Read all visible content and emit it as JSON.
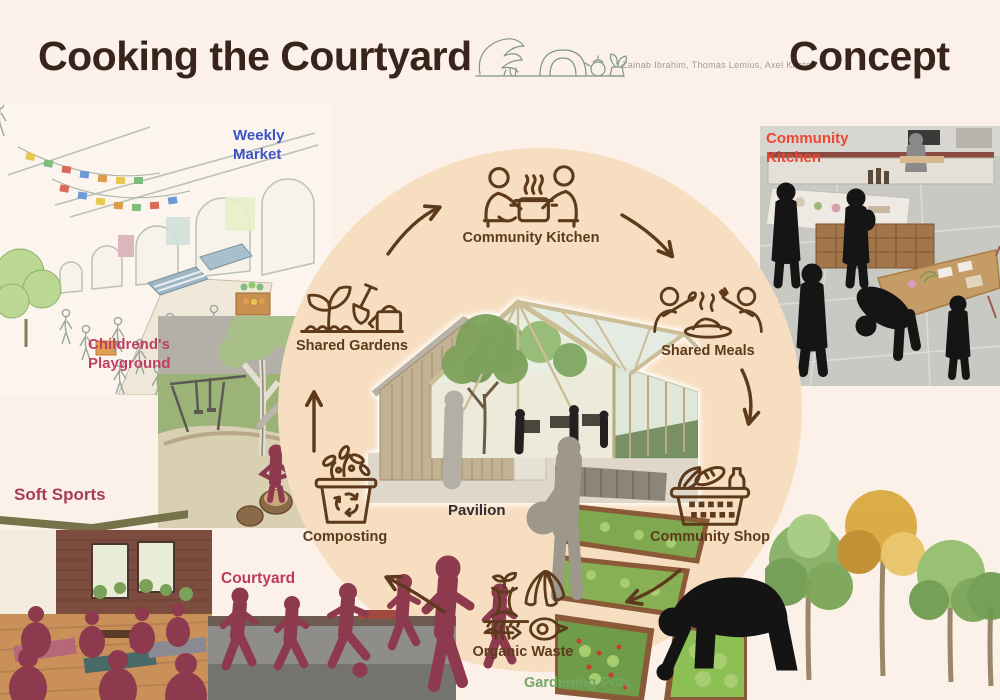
{
  "header": {
    "title": "Cooking the Courtyard",
    "authors": "Zainab Ibrahim, Thomas Lemius, Axel Kristen",
    "concept": "Concept"
  },
  "cycle": {
    "center_label": "Pavilion",
    "steps": [
      {
        "id": "community-kitchen",
        "label": "Community Kitchen",
        "icon": "cooks-at-pot-icon"
      },
      {
        "id": "shared-meals",
        "label": "Shared Meals",
        "icon": "people-sharing-plate-icon"
      },
      {
        "id": "community-shop",
        "label": "Community Shop",
        "icon": "grocery-basket-icon"
      },
      {
        "id": "organic-waste",
        "label": "Organic Waste",
        "icon": "food-scraps-icon"
      },
      {
        "id": "composting",
        "label": "Composting",
        "icon": "compost-bin-icon"
      },
      {
        "id": "shared-gardens",
        "label": "Shared Gardens",
        "icon": "sprout-shovel-watering-can-icon"
      }
    ]
  },
  "surroundings": {
    "weekly_market": "Weekly Market",
    "childrens_playground": "Childrend's Playground",
    "soft_sports": "Soft Sports",
    "courtyard": "Courtyard",
    "community_kitchen": "Community Kitchen",
    "gardening_pots": "Gardening Pots"
  },
  "colors": {
    "background": "#fcf1e9",
    "cycle_circle": "#f8dec1",
    "diagram_brown": "#5d3a1c",
    "title_brown": "#38241c",
    "label_blue": "#3b53c6",
    "label_crimson": "#c04064",
    "label_maroon": "#a83c55",
    "label_red": "#ef4633",
    "label_green": "#71a663",
    "silhouette_maroon": "#8d3a4f"
  }
}
